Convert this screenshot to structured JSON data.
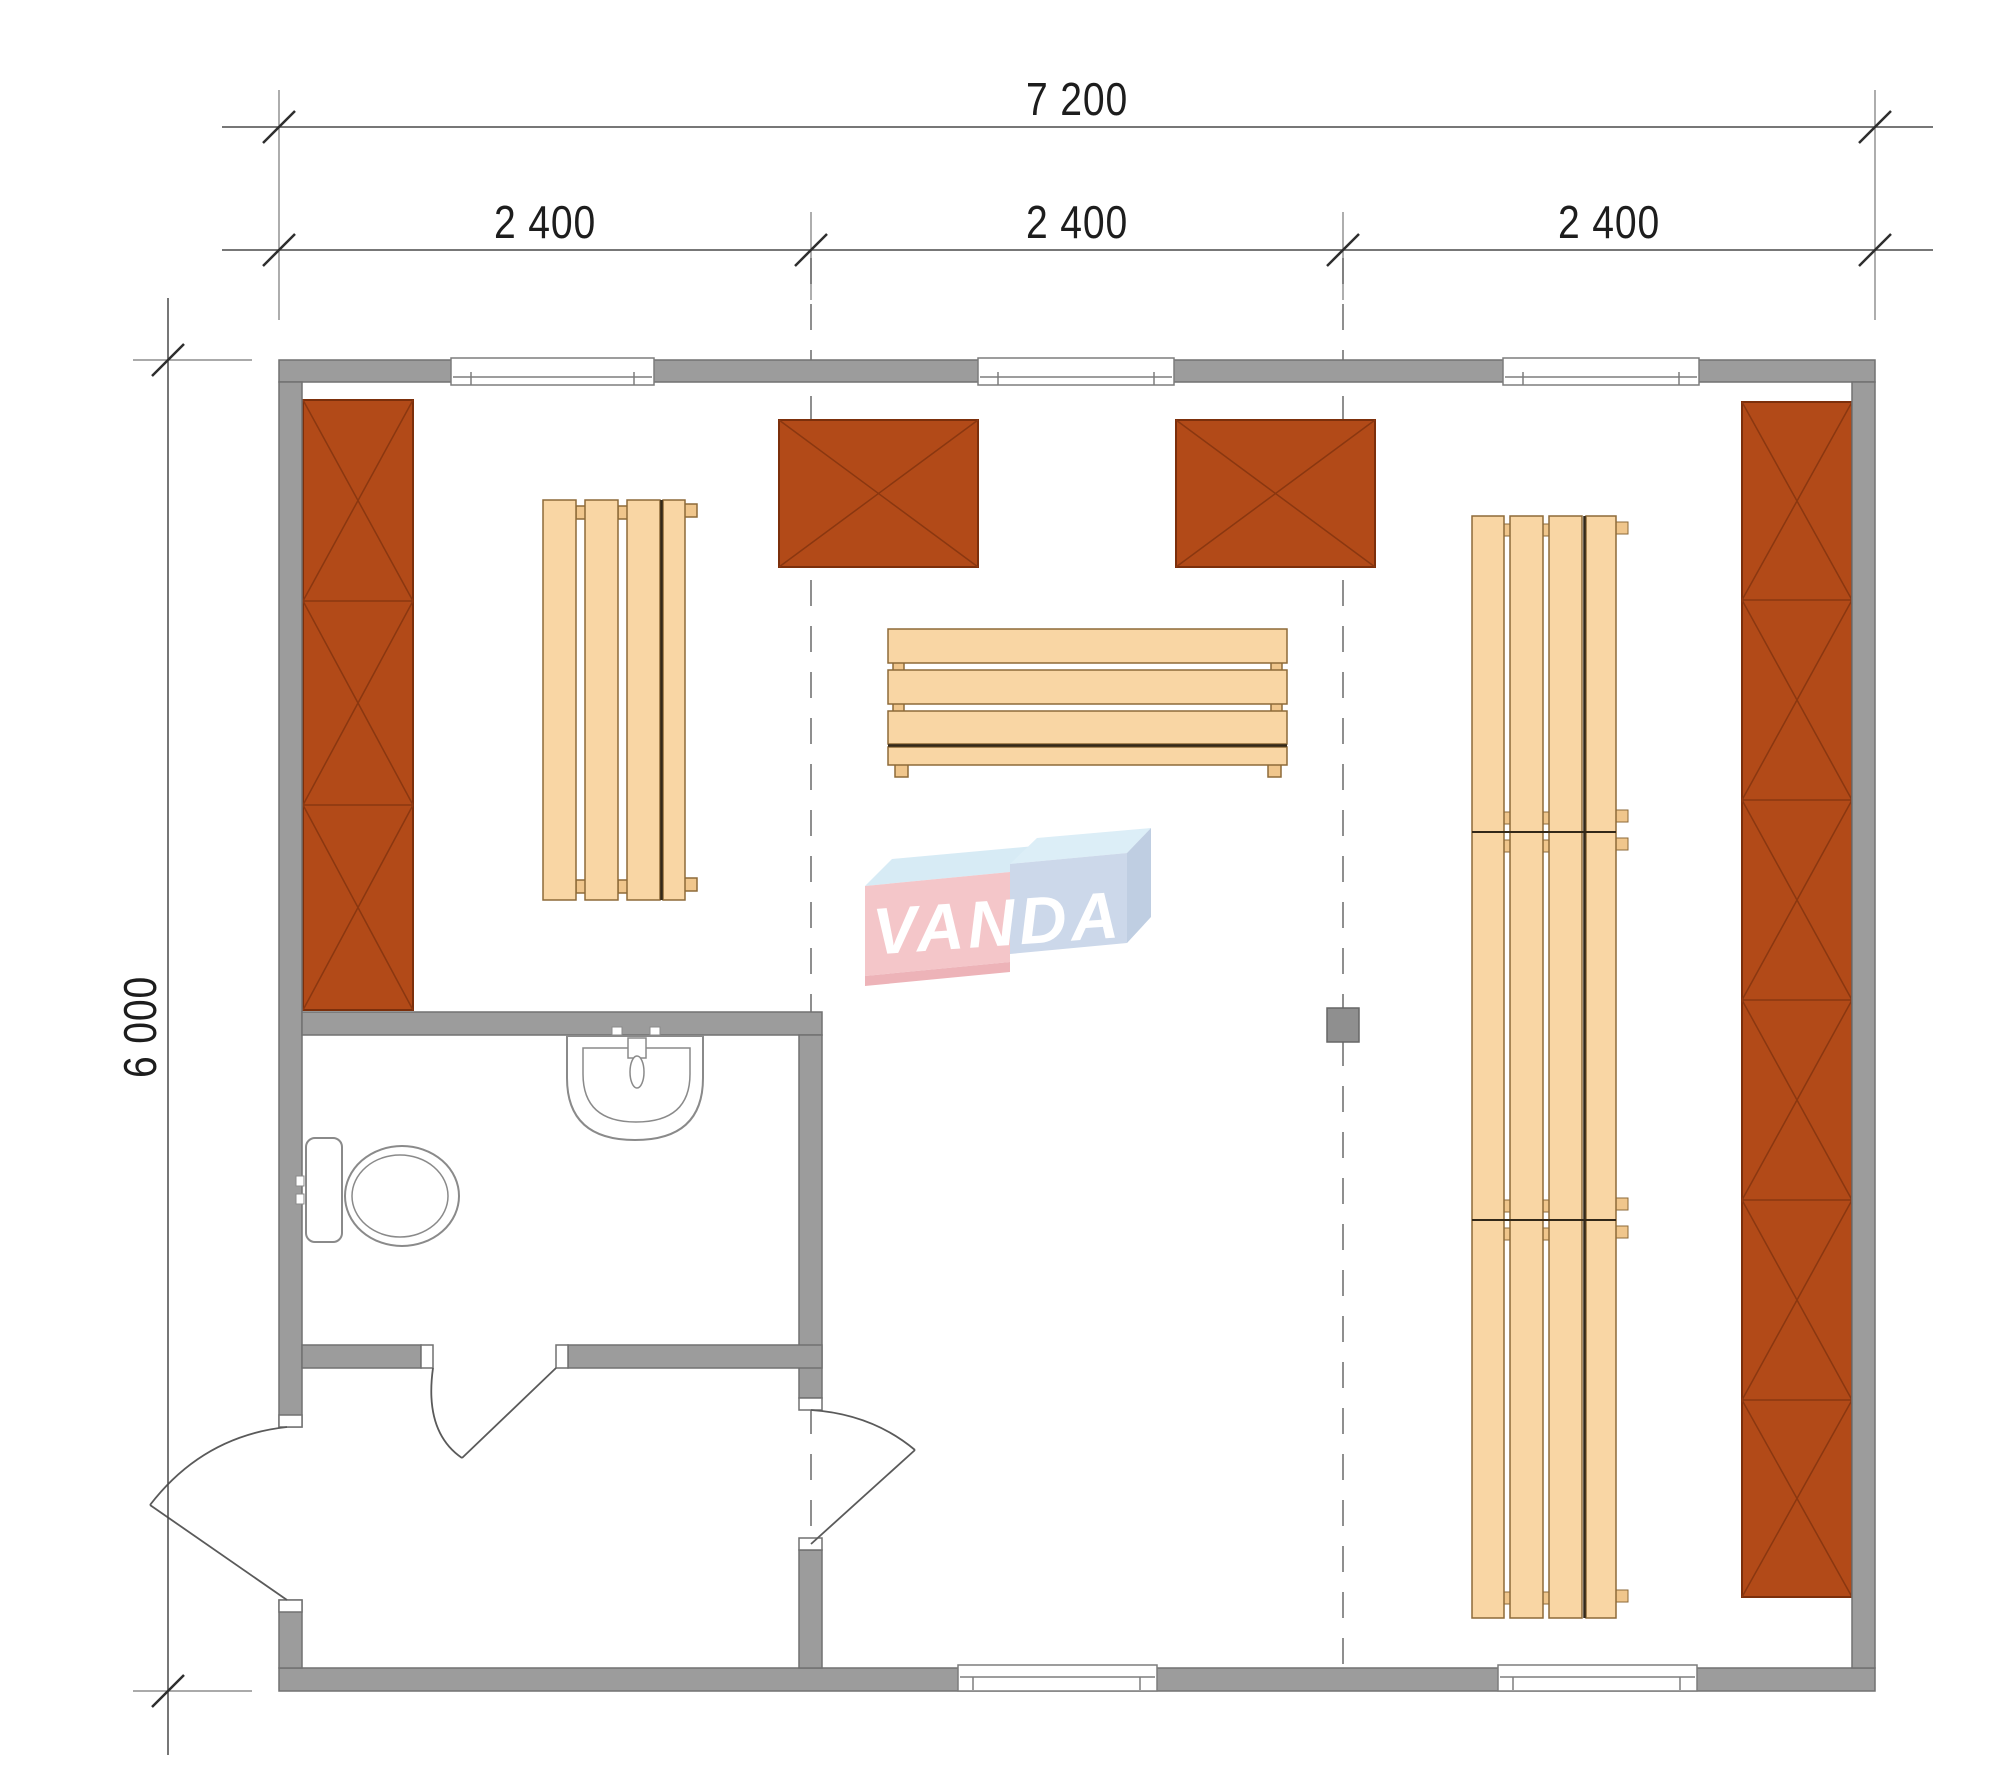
{
  "document": {
    "type": "architectural-floor-plan",
    "background_color": "#ffffff"
  },
  "dimensions": {
    "total_width_label": "7 200",
    "bay_labels": [
      "2 400",
      "2 400",
      "2 400"
    ],
    "height_label": "6 000"
  },
  "watermark": {
    "brand": "VANDA",
    "box_left_color": "#f4c6c9",
    "box_right_color": "#ccd8ea",
    "bevel_color": "#d7ebf5",
    "text_color": "#ffffff"
  },
  "palette": {
    "wall_fill": "#9c9c9c",
    "wall_edge": "#717171",
    "cabinet_fill": "#b24a18",
    "cabinet_line": "#7c2f0b",
    "bench_fill": "#f9d6a4",
    "bench_line": "#8d6a38",
    "bench_joint_line": "#332818",
    "fixture_line": "#8a8a8a",
    "dimension_line": "#4a4a4a",
    "dashed_grid_line": "#8f8f8f",
    "heater_fill": "#8f8f8f",
    "text_color": "#1d1d1d"
  },
  "plan": {
    "rooms": [
      "main-room",
      "bathroom",
      "vestibule"
    ],
    "furniture": [
      "wardrobe-left",
      "wardrobe-right",
      "wall-box-1",
      "wall-box-2",
      "bench-left",
      "bench-middle",
      "bench-right",
      "heater"
    ],
    "fixtures": [
      "toilet",
      "sink"
    ],
    "windows_top": 3,
    "windows_bottom": 2,
    "doors": 3
  }
}
